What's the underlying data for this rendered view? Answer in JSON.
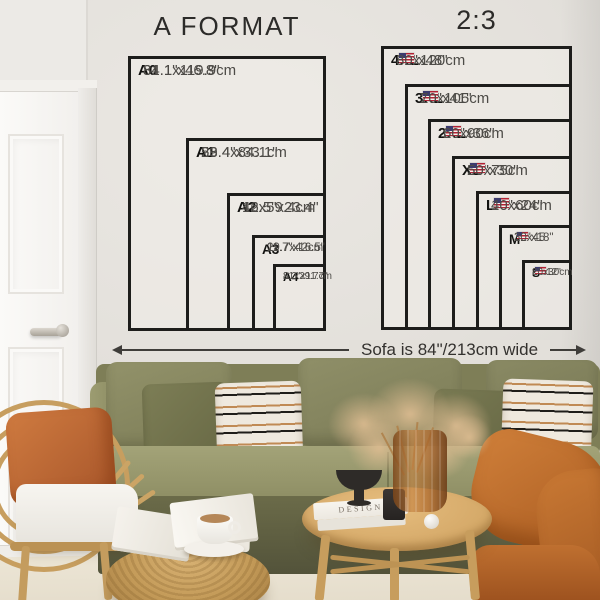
{
  "left_chart": {
    "title": "A FORMAT",
    "items": [
      {
        "code": "A0",
        "inches": "31.1\"x46.8\"",
        "cm": "84.1x119.9cm"
      },
      {
        "code": "A1",
        "inches": "23.4\"x33.1\"",
        "cm": "59.4x84.1cm"
      },
      {
        "code": "A2",
        "inches": "16.5\"x23.4\"",
        "cm": "42x59.4cm"
      },
      {
        "code": "A3",
        "inches": "11.7\"x16.5\"",
        "cm": "29.7x42cm"
      },
      {
        "code": "A4",
        "inches": "8.3\"x11.7\"",
        "cm": "21x29.7cm"
      }
    ]
  },
  "right_chart": {
    "title": "2:3",
    "flag_icon": "us-flag",
    "items": [
      {
        "code": "4XL",
        "inches": "32\"x48\"",
        "cm": "80x120cm"
      },
      {
        "code": "3XL",
        "inches": "27\"x41\"",
        "cm": "70x105cm"
      },
      {
        "code": "2XL",
        "inches": "24\"x36\"",
        "cm": "60x90cm"
      },
      {
        "code": "XL",
        "inches": "20\"x30\"",
        "cm": "50x75cm"
      },
      {
        "code": "L",
        "inches": "16\"x24\"",
        "cm": "40x60cm"
      },
      {
        "code": "M",
        "inches": "12\"x18\"",
        "cm": "30x45"
      },
      {
        "code": "S",
        "inches": "8\"x12\"",
        "cm": "20x30cm"
      }
    ]
  },
  "sofa_note": "Sofa is 84\"/213cm wide",
  "decor": {
    "book_spine": "DESIGN"
  },
  "colors": {
    "wall": "#e3e0db",
    "chart_line": "#1d1d1b",
    "label_dim": "#4d4b47",
    "sofa_olive": "#8b8b5f",
    "accent_orange": "#c06a33",
    "wood": "#c9a263",
    "rug": "#e9e2d2"
  }
}
